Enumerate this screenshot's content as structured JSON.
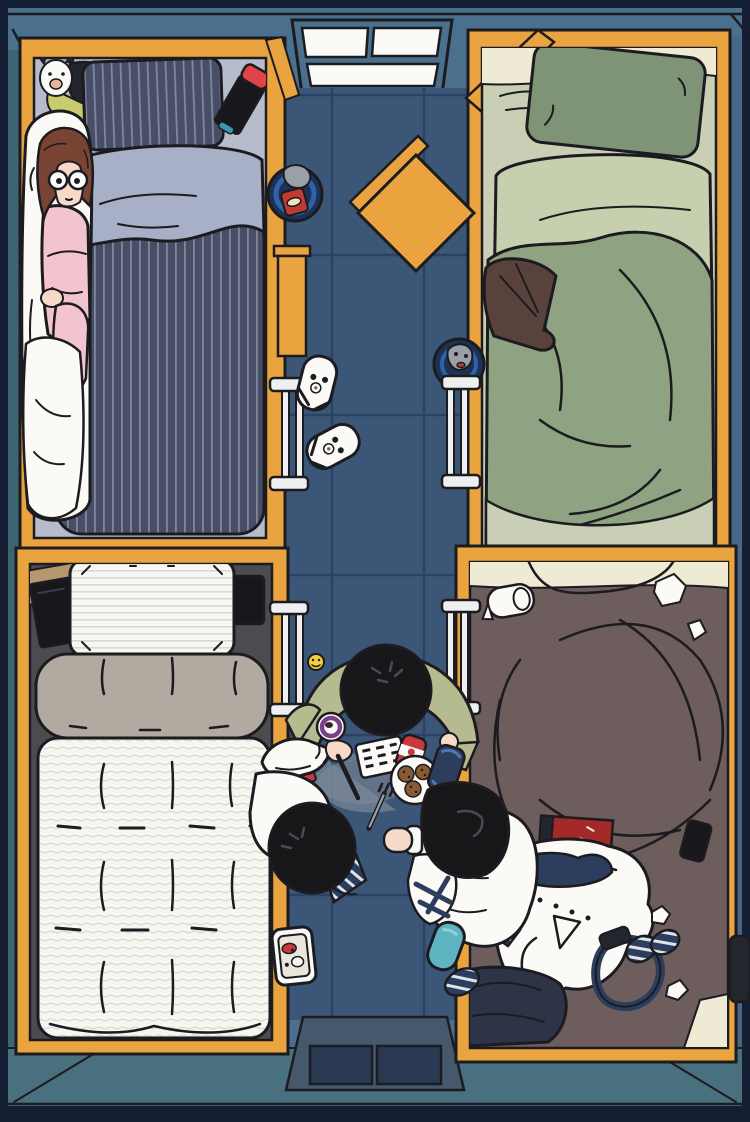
{
  "scene": {
    "description": "Top-down illustration of a shared dormitory bedroom at night: four wooden-framed beds in the corners, a blue tiled corridor in the middle where three dark-haired people sit around snacks and drinks, a window at the top, and an entryway with two dark mats at the bottom.",
    "style": "flat cartoon / anime illustration, top-down view",
    "room": {
      "window_pane_count": 3,
      "entry_mat_count": 2,
      "ladder_count": 4,
      "slipper_count": 2
    },
    "beds": [
      {
        "position": "top-left",
        "bedding": "navy striped duvet and pillow with light lavender sheet",
        "occupant": "girl with brown hair, glasses and pink pajamas hugging a white body pillow",
        "items": [
          "white alpaca plush",
          "dark plush",
          "game console with red controller"
        ]
      },
      {
        "position": "top-right",
        "bedding": "pale green sheet, sage pillow, lumpy sage-green blanket",
        "occupant": "person sleeping fully under the blanket",
        "items": [
          "brown jacket"
        ]
      },
      {
        "position": "bottom-left",
        "bedding": "white striped pillow, beige folded blanket roll, white quilted duvet, neatly made",
        "occupant": "empty",
        "items": [
          "black tablet on tan folder",
          "black phone"
        ]
      },
      {
        "position": "bottom-right",
        "bedding": "taupe-brown duvet, very messy",
        "occupant": "empty",
        "items": [
          "toilet paper roll",
          "crumpled tissues",
          "red book",
          "white shirt with navy tie",
          "navy lanyard",
          "rolled striped socks",
          "dark trousers",
          "black phone"
        ]
      }
    ],
    "people": [
      {
        "id": "person-top",
        "hair": "black",
        "clothes": "olive green long-sleeve shirt",
        "action": "leaning over snacks, holding a purple-ringed cup"
      },
      {
        "id": "person-left",
        "hair": "black",
        "clothes": "white frilled shirt",
        "action": "reaching out holding a pen"
      },
      {
        "id": "person-right",
        "hair": "black",
        "clothes": "white shirt and trousers",
        "action": "sitting by the right bed, one foot bare"
      }
    ],
    "floor_items": [
      "blue round bin with red chips bag",
      "orange stool turned 45 degrees",
      "small orange shelf",
      "blue cup with grey mascot",
      "two white panda slippers",
      "yellow smiley ball",
      "cracker sheet",
      "red-and-white soda can",
      "plate of chocolate-chip cookies",
      "blue pouch",
      "purple instant cup",
      "white cup",
      "fork",
      "grey spill stain",
      "white bento tray",
      "teal slipper",
      "navy striped sock roll",
      "black bag"
    ]
  },
  "palette": {
    "ink": "#1b1b20",
    "border": "#141f33",
    "wall": "#4a708e",
    "wall_teal": "#3d6473",
    "wall_right": "#44678a",
    "floor": "#3c5677",
    "floor_line": "#2b4265",
    "entry_teal": "#48707e",
    "genkan": "#46586c",
    "mat": "#2b3a52",
    "wood": "#e9a440",
    "white": "#fbfaf6",
    "bed1_sheet": "#b7bccd",
    "bed1_navy": "#474e66",
    "bed1_stripe": "#7f87a0",
    "bed1_duvet": "#a7b0c6",
    "hair_brown": "#7a4434",
    "skin": "#f6d9c9",
    "pajama": "#f2c4cf",
    "plush_lime": "#c8cc6e",
    "plush_green": "#3e7a52",
    "dark_item": "#23262c",
    "switch_red": "#e04448",
    "bed2_sheet": "#c9cfb4",
    "bed2_cream": "#efead3",
    "bed2_pillow": "#7f9377",
    "bed2_duvet": "#c6cfae",
    "bed2_blanket": "#8fa383",
    "jacket_brown": "#5a423c",
    "bed3_base": "#4b4b50",
    "bed3_pillow": "#f6f6f2",
    "bed3_stripe": "#d9d8d1",
    "bed3_roll": "#b2a9a0",
    "folder_tan": "#b6976f",
    "device_black": "#17171c",
    "bed4_bedding": "#6d5d5c",
    "book_red": "#a32a28",
    "tie_navy": "#2c3d5e",
    "pants_navy": "#2e3448",
    "hair_black": "#17171a",
    "shirt_olive": "#b5bb8e",
    "bin_navy": "#1d3356",
    "bin_blue": "#2f63a9",
    "chips_red": "#c03a33",
    "smiley_yellow": "#f3cf3a",
    "can_red": "#c9383c",
    "cookie_brown": "#8a5a32",
    "spill_gray": "#7f8b99",
    "cup_purple": "#7a3f8c",
    "slipper_teal": "#5fb4c2",
    "metal_white": "#edeff0",
    "gray_blob": "#9aa0a8"
  }
}
